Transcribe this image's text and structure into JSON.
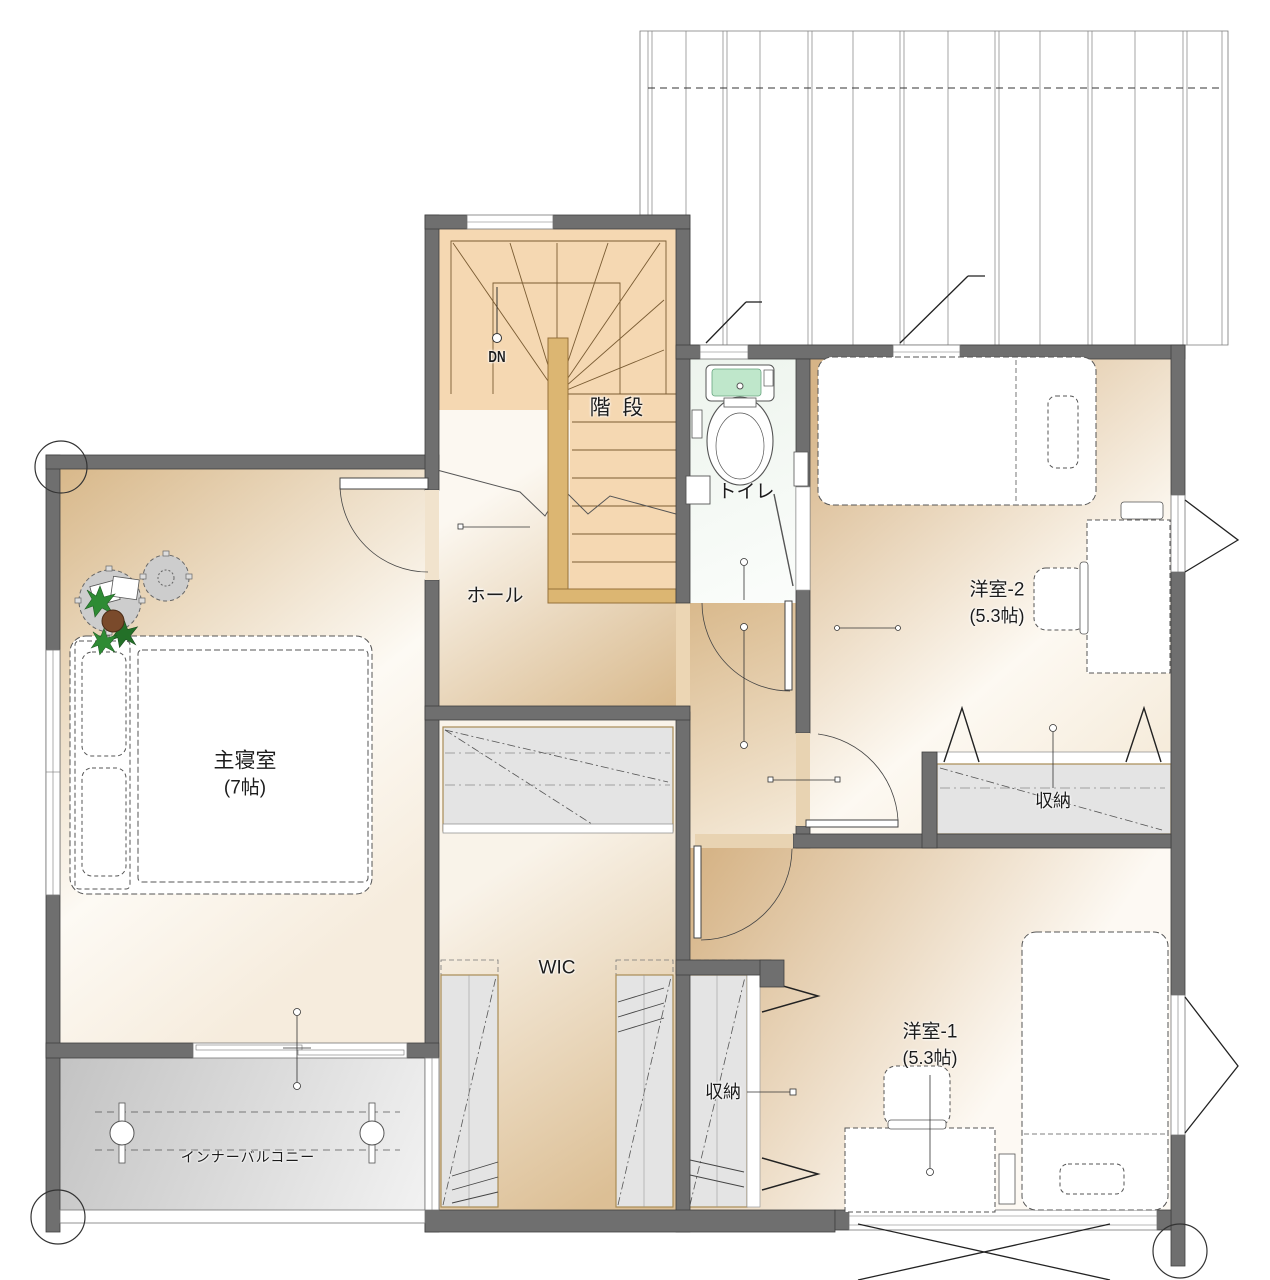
{
  "rooms": {
    "stairs": {
      "label": "階 段"
    },
    "hall": {
      "label": "ホール"
    },
    "toilet": {
      "label": "トイレ"
    },
    "master_bedroom": {
      "label": "主寝室",
      "size": "(7帖)"
    },
    "western_room_2": {
      "label": "洋室-2",
      "size": "(5.3帖)"
    },
    "western_room_1": {
      "label": "洋室-1",
      "size": "(5.3帖)"
    },
    "wic": {
      "label": "WIC"
    },
    "storage_west2": {
      "label": "収納"
    },
    "storage_west1": {
      "label": "収納"
    },
    "inner_balcony": {
      "label": "インナーバルコニー"
    }
  },
  "stair_note": {
    "down": "DN"
  },
  "colors": {
    "wall": "#6f6f6f",
    "wall_stroke": "#3f3f3f",
    "stair_floor": "#f5d8b2",
    "railing": "#dcb672",
    "room_floor_dark": "#d8b88a",
    "room_floor_light": "#fdfaf4",
    "closet_fill": "#e4e4e4",
    "closet_border": "#a98c55",
    "toilet_floor": "#f1f7f1",
    "toilet_tank_green": "#bfe7cb",
    "balcony_dark": "#c3c3c3",
    "balcony_light": "#f2f2f2",
    "plant_green": "#2e8b34",
    "plant_pot": "#7a4a2b",
    "line": "#4a4a4a"
  }
}
